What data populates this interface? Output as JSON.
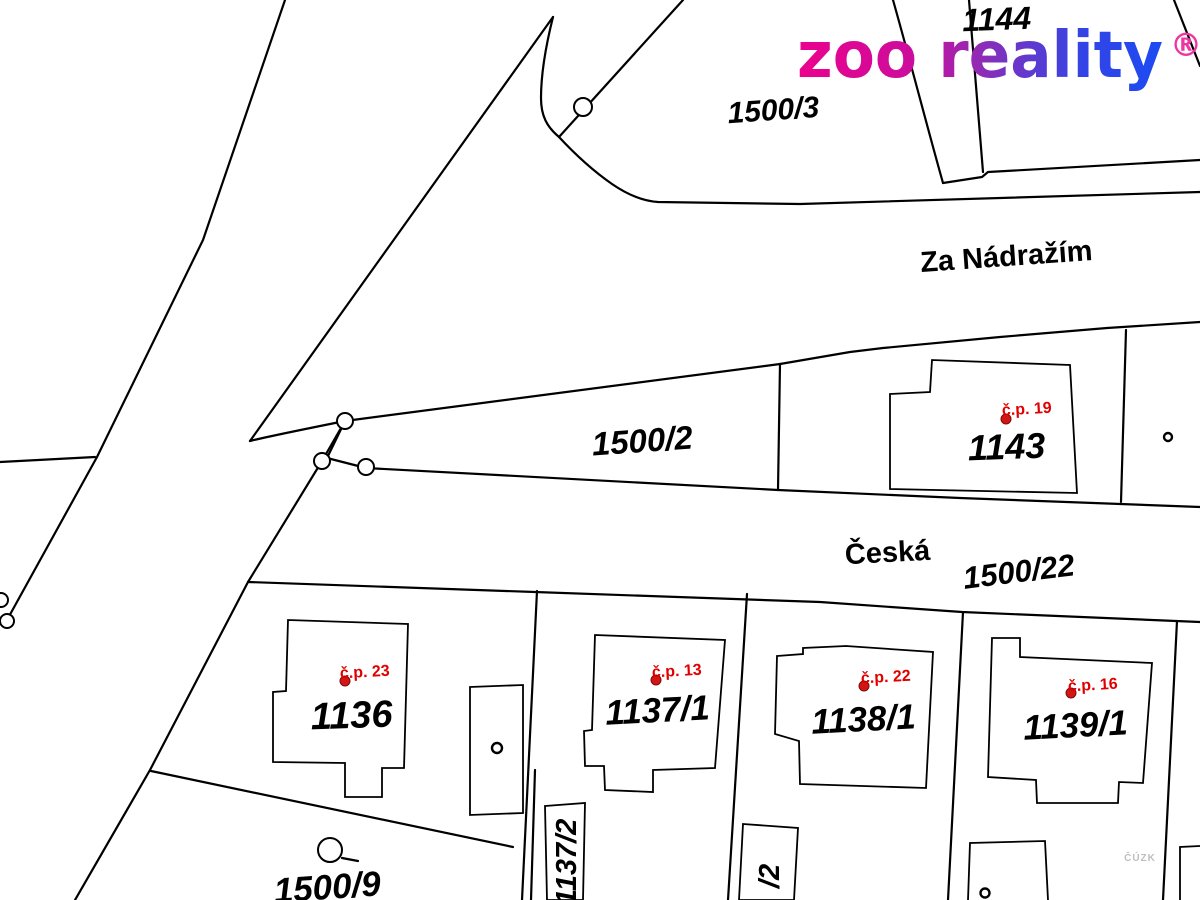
{
  "brand": {
    "wordmark": "zoo reality",
    "registered": "®",
    "gradient": [
      "#ec018e",
      "#cb0d9d",
      "#9729b2",
      "#6438cc",
      "#3344e6",
      "#1c4bf2"
    ]
  },
  "map": {
    "highlighted_parcel": {
      "label": "1500/2"
    },
    "streets": [
      {
        "name": "Za Nádražím"
      },
      {
        "name": "Česká"
      }
    ],
    "parcels": [
      {
        "label": "1144"
      },
      {
        "label": "1500/3"
      },
      {
        "label": "1500/2"
      },
      {
        "label": "1143"
      },
      {
        "label": "1500/22"
      },
      {
        "label": "1136"
      },
      {
        "label": "1137/1"
      },
      {
        "label": "1138/1"
      },
      {
        "label": "1139/1"
      },
      {
        "label": "1500/9"
      },
      {
        "label": "1137/2"
      },
      {
        "label": "/2"
      }
    ],
    "house_numbers": [
      {
        "label": "č.p. 19"
      },
      {
        "label": "č.p. 23"
      },
      {
        "label": "č.p. 13"
      },
      {
        "label": "č.p. 22"
      },
      {
        "label": "č.p. 16"
      }
    ],
    "watermark": "ČÚZK",
    "colors": {
      "parcel_highlight": "#8cb3d8",
      "line": "#000000",
      "house_number": "#e00000"
    }
  }
}
